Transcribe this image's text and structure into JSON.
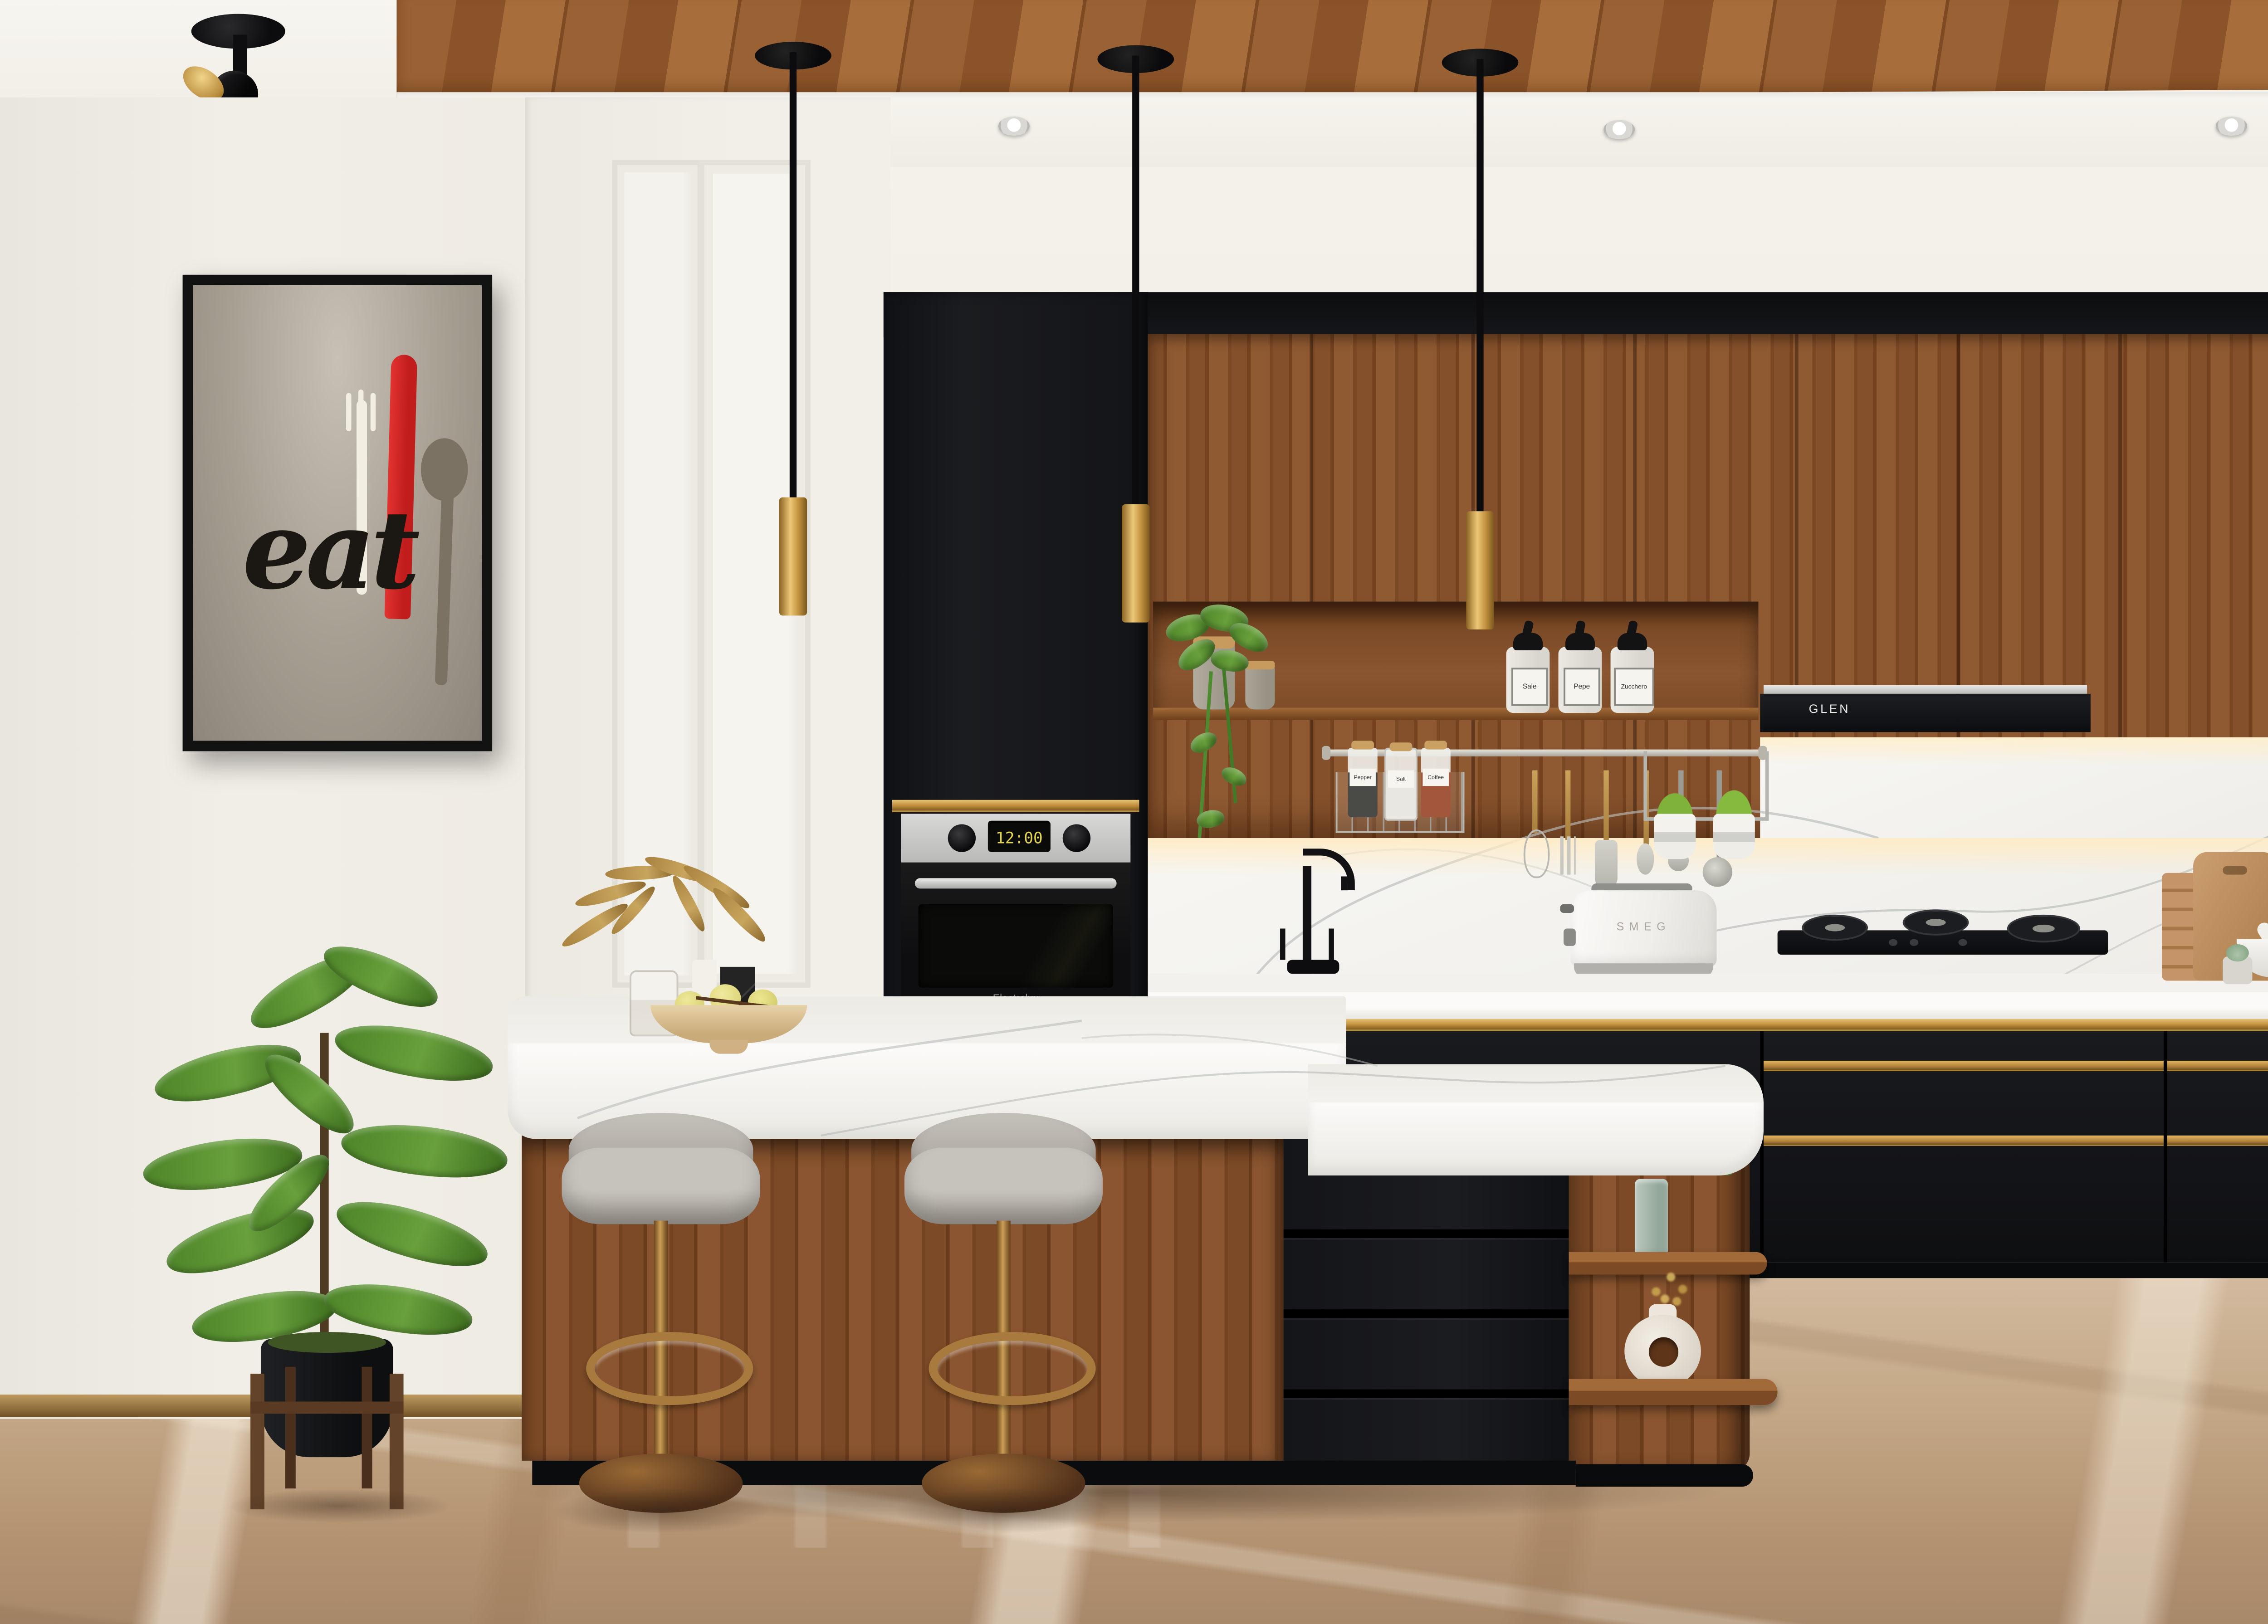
{
  "scene": {
    "title": "Modern walnut / black / brass kitchen 3D render",
    "style": "photoreal interior visualization"
  },
  "poster": {
    "text": "eat",
    "frame_color": "#141414",
    "canvas_color": "#a59e92",
    "fork_color": "#f3eee2",
    "knife_color": "#d02522",
    "spoon_color": "#7b7264",
    "text_color": "#1b1712"
  },
  "appliances": {
    "oven": {
      "brand": "Electrolux",
      "display_time": "12:00",
      "display_color": "#e4d44a"
    },
    "toaster": {
      "brand": "SMEG"
    },
    "hood": {
      "brand": "GLEN"
    },
    "hob": {
      "burners": 3
    }
  },
  "shelf_niche": {
    "bottles": [
      {
        "label": "Sale"
      },
      {
        "label": "Pepe"
      },
      {
        "label": "Zucchero"
      }
    ],
    "stone_jars": 2
  },
  "utensil_rack": {
    "jars": [
      {
        "label": "Pepper"
      },
      {
        "label": "Salt"
      },
      {
        "label": "Coffee"
      }
    ],
    "utensils": [
      "whisk",
      "fork",
      "spatula",
      "spoon",
      "small-ladle",
      "ladle"
    ],
    "herb_pots": 2
  },
  "island": {
    "stools": 2,
    "drawers": 4,
    "decor": [
      "green glass vase with eucalyptus",
      "white donut vase with dried gold sprigs",
      "dried leaf arrangement",
      "fruit bowl",
      "candle",
      "black marble block"
    ]
  },
  "lighting": {
    "pendants": 3,
    "downlights": 3,
    "spotlights": 1
  },
  "palette": {
    "wall": "#efece5",
    "cabinet_black": "#17181a",
    "walnut": "#84502b",
    "brass": "#c19140",
    "marble_white": "#f6f5f1",
    "floor_tan": "#c2a584",
    "stool_grey": "#b3aea7",
    "plant_green": "#4c8428"
  }
}
